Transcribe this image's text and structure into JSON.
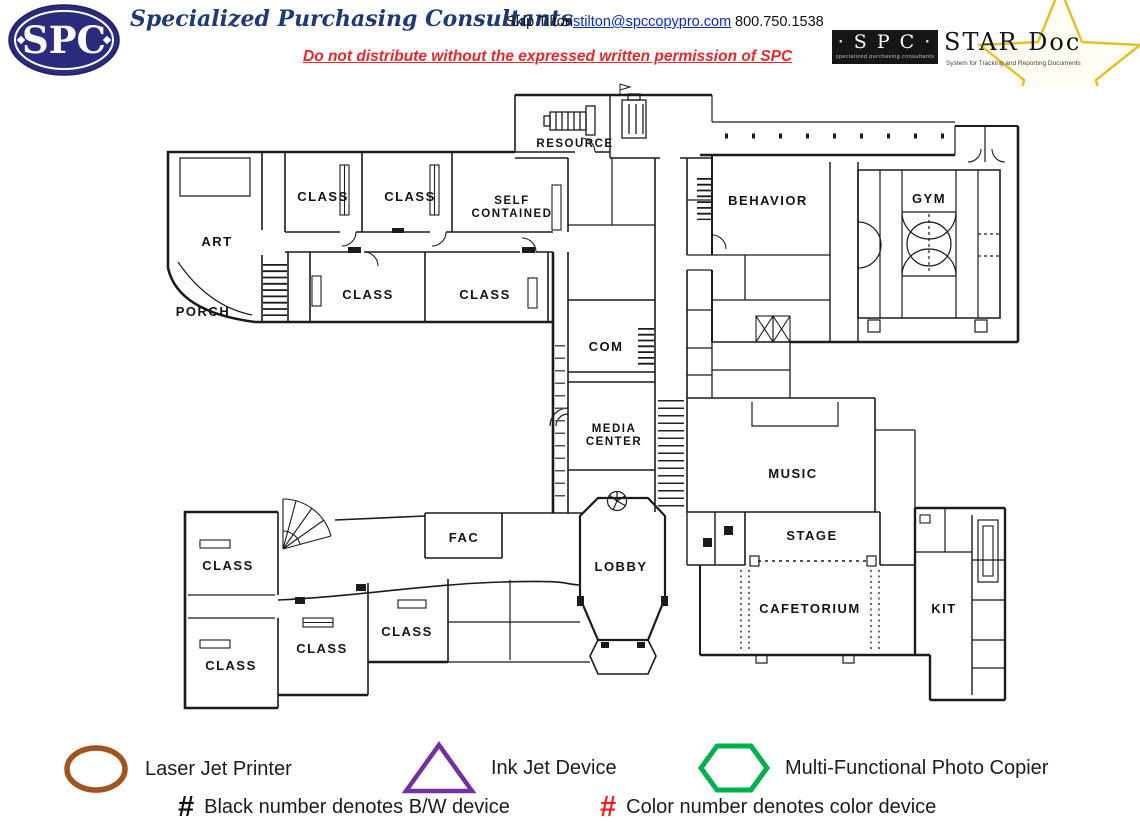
{
  "header": {
    "logo_text": "SPC",
    "company": "Specialized Purchasing Consultants",
    "contact_name": "Skip Tilton",
    "contact_email": "stilton@spccopypro.com",
    "contact_phone": "800.750.1538",
    "notice": "Do not distribute without the expressed written permission of SPC",
    "brand_navy": "#2b2b7e",
    "notice_red": "#e8262b",
    "star_doc": {
      "spc_label": "· S P C ·",
      "spc_caption": "specialized purchasing consultants",
      "title": "STAR Doc",
      "caption": "System for Tracking and Reporting Documents",
      "star_gold": "#e3c02c"
    }
  },
  "plan": {
    "room_labels": [
      "RESOURCE",
      "CLASS",
      "CLASS",
      "SELF",
      "CONTAINED",
      "ART",
      "PORCH",
      "CLASS",
      "CLASS",
      "BEHAVIOR",
      "GYM",
      "COM",
      "MEDIA",
      "CENTER",
      "MUSIC",
      "STAGE",
      "FAC",
      "LOBBY",
      "CAFETORIUM",
      "KIT",
      "CLASS",
      "CLASS",
      "CLASS",
      "CLASS"
    ]
  },
  "legend": {
    "items": [
      {
        "symbol": "ellipse",
        "color": "#9e551e",
        "label": "Laser Jet Printer"
      },
      {
        "symbol": "triangle",
        "color": "#7030a0",
        "label": "Ink Jet Device"
      },
      {
        "symbol": "hexagon",
        "color": "#00b050",
        "label": "Multi-Functional Photo Copier"
      }
    ],
    "notes": [
      {
        "hash": "#",
        "color": "#111111",
        "text": "Black number denotes B/W device"
      },
      {
        "hash": "#",
        "color": "#ee1c1c",
        "text": "Color number denotes color device"
      }
    ]
  }
}
